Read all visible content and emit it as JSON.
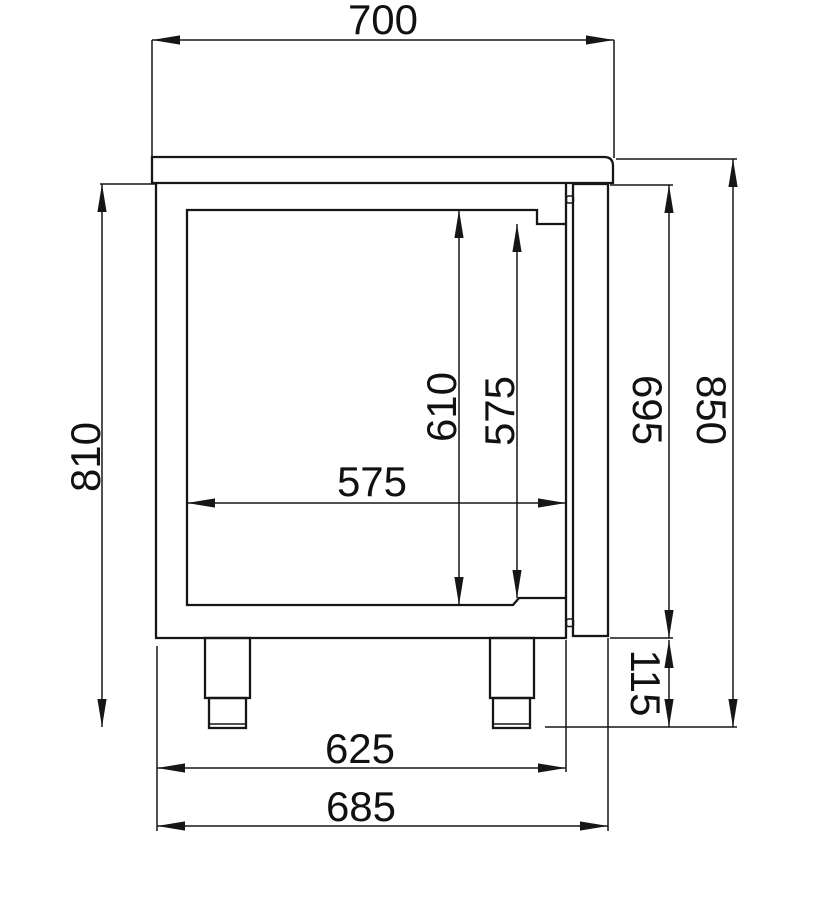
{
  "drawing": {
    "type": "technical-side-section",
    "subject": "counter-cabinet-with-door-and-legs",
    "colors": {
      "line": "#161616",
      "background": "#ffffff"
    },
    "dims": {
      "worktop_depth": "700",
      "body_height": "810",
      "interior_height": "610",
      "door_opening_height": "575",
      "interior_depth": "575",
      "door_height": "695",
      "overall_height": "850",
      "leg_height": "115",
      "body_depth": "625",
      "overall_depth": "685"
    }
  }
}
